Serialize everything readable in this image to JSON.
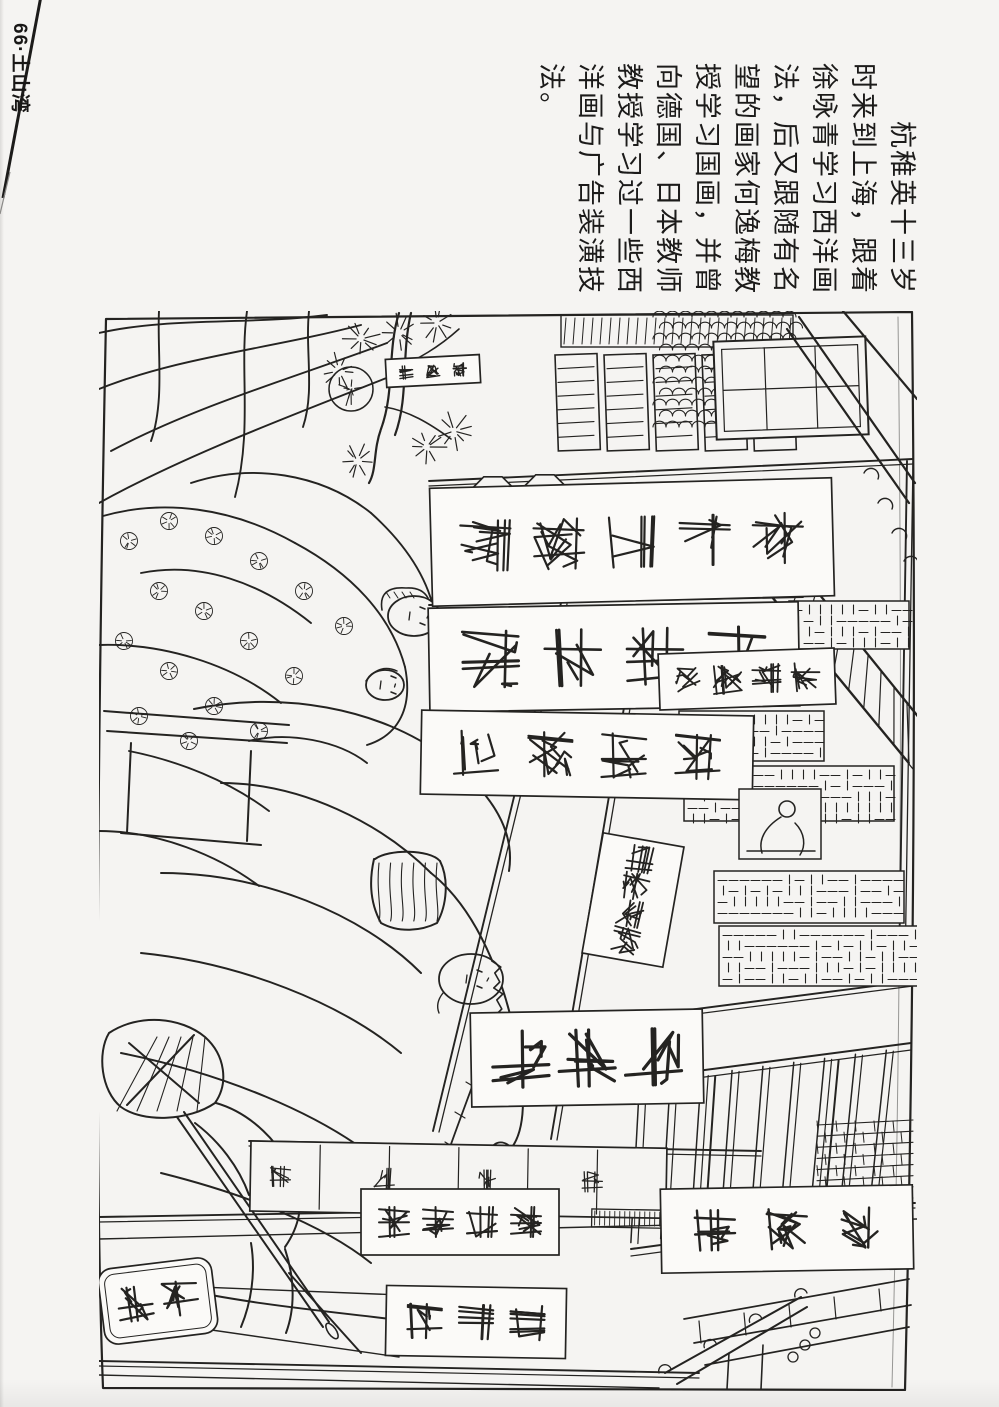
{
  "page": {
    "header": "66·土山湾",
    "caption_lines": [
      "　　杭稚英十三岁",
      "时来到上海，跟着",
      "徐咏青学习西洋画",
      "法，后又跟随有名",
      "望的画家何逸梅教",
      "授学习国画，并曾",
      "向德国、日本教师",
      "教授学习过一些西",
      "洋画与广告装潢技",
      "法。"
    ]
  },
  "colors": {
    "paper": "#f5f4f2",
    "ink": "#242321",
    "banner_fill": "#fbfaf8"
  },
  "illustration": {
    "frame": "M7,8 L813,1 Q819,540 806,1079 L4,1077 Q-8,760 7,8 Z",
    "curl": "M799,6 Q806,540 793,1076",
    "drape_strokes": [
      "M0,22 C70,6 150,14 228,4",
      "M0,78 C80,46 170,38 262,14",
      "M12,140 C95,96 185,70 288,32",
      "M0,192 C90,142 200,102 305,60",
      "M148,0 C140,58 154,118 136,186",
      "M60,0 C58,40 66,90 52,130",
      "M210,0 C206,40 216,80 204,116",
      "M4,205 C64,188 132,196 196,232",
      "M196,232 C252,262 292,304 306,356",
      "M306,356 C314,396 300,424 268,434",
      "M42,262 C102,250 162,272 212,312",
      "M0,334 C62,332 132,352 182,392",
      "M92,172 C152,152 222,162 272,202",
      "M272,202 C312,238 330,272 336,304",
      "M150,430 C190,420 240,430 268,452",
      "M30,440 C80,450 130,470 170,500",
      "M0,520 C60,520 120,545 160,575"
    ],
    "man_strokes": [
      "M95,398 C180,380 280,396 346,446 C396,484 416,522 410,560",
      "M5,400 L190,414",
      "M8,420 L188,432",
      "M32,432 L28,522",
      "M152,440 L148,530",
      "M22,522 L162,534",
      "M122,472 C202,472 282,512 332,562",
      "M62,562 C162,562 262,602 322,662",
      "M42,642 C142,652 242,692 302,742",
      "M22,742 C122,762 222,802 282,852",
      "M62,862 C142,882 222,912 272,952",
      "M72,976 C162,996 252,1002 322,1012",
      "M332,562 C382,602 412,682 422,762 C427,802 422,827 410,840",
      "M276,548 C290,538 330,538 341,550",
      "M275,548 C270,570 271,592 282,612 C300,622 322,620 338,612 C348,594 350,568 341,550"
    ],
    "basket_hatch": {
      "x": 280,
      "y": 552,
      "w": 58,
      "h": 58,
      "n": 6
    },
    "pole_strokes": [
      "M10,722 C40,702 82,706 106,726 C126,744 130,772 116,792 C90,810 44,812 22,796 C2,780 -2,742 10,722",
      "M30,732 L100,792",
      "M95,724 L28,794",
      "M78,806 L224,1016",
      "M85,801 L230,1011",
      "M117,792 C152,802 182,832 196,866 C206,892 200,916 186,936",
      "M152,932 C157,962 152,992 142,1016",
      "M186,938 C196,968 196,998 187,1022",
      "M96,812 C120,830 140,856 150,884",
      "M190,962 L262,1042"
    ],
    "bundle_hatch": {
      "x": 18,
      "y": 726,
      "w": 100,
      "h": 74,
      "n": 5
    },
    "pole_tip": [
      233,
      1020,
      9,
      4
    ],
    "tree": {
      "trunks": [
        "M300,2 C288,40 296,80 282,118 C274,140 278,158 270,172",
        "M312,2 C302,44 310,86 296,124"
      ],
      "branches": [
        "M292,60 C320,48 340,36 360,18",
        "M286,96 C310,100 330,112 352,128"
      ],
      "tufts": [
        [
          262,
          28
        ],
        [
          300,
          22
        ],
        [
          338,
          12
        ],
        [
          355,
          120
        ],
        [
          328,
          136
        ],
        [
          258,
          150
        ],
        [
          240,
          60
        ]
      ]
    },
    "bun": [
      252,
      78,
      22
    ],
    "medallions": [
      [
        30,
        230
      ],
      [
        70,
        210
      ],
      [
        115,
        225
      ],
      [
        160,
        250
      ],
      [
        205,
        280
      ],
      [
        245,
        315
      ],
      [
        60,
        280
      ],
      [
        105,
        300
      ],
      [
        150,
        330
      ],
      [
        195,
        365
      ],
      [
        25,
        330
      ],
      [
        70,
        360
      ],
      [
        115,
        395
      ],
      [
        160,
        420
      ],
      [
        40,
        405
      ],
      [
        90,
        430
      ]
    ],
    "faces": [
      {
        "cx": 315,
        "cy": 305,
        "rx": 26,
        "ry": 20,
        "type": "bonnet"
      },
      {
        "cx": 286,
        "cy": 374,
        "rx": 19,
        "ry": 15,
        "type": "cap"
      },
      {
        "cx": 372,
        "cy": 668,
        "rx": 32,
        "ry": 25,
        "type": "man"
      }
    ],
    "hand": [
      404,
      848,
      13,
      17
    ],
    "braid": "M398,702 C380,762 362,802 342,862",
    "braid_ticks": [
      [
        392,
        714
      ],
      [
        382,
        744
      ],
      [
        372,
        774
      ],
      [
        361,
        804
      ],
      [
        351,
        834
      ]
    ],
    "beams": [
      [
        330,
        170,
        814,
        148
      ],
      [
        330,
        294,
        704,
        286
      ],
      [
        520,
        708,
        814,
        670
      ],
      [
        150,
        830,
        662,
        840
      ],
      [
        0,
        906,
        816,
        892
      ],
      [
        0,
        1050,
        600,
        1062
      ]
    ],
    "posts": [
      [
        462,
        292,
        334,
        820
      ],
      [
        542,
        296,
        452,
        828
      ],
      [
        808,
        150,
        800,
        660
      ]
    ],
    "shutters": {
      "x": 456,
      "y": 44,
      "pw": 42,
      "ph": 96,
      "gap": 7,
      "n": 5,
      "slats": 6
    },
    "upper_band": {
      "x": 462,
      "y": 4,
      "w": 232,
      "h": 32,
      "step": 9
    },
    "scallops": {
      "x": 554,
      "y": 6,
      "w": 142,
      "h": 118,
      "r": 6.5,
      "row": 11
    },
    "gable": {
      "x": 616,
      "y": 28,
      "w": 152,
      "h": 98
    },
    "ridges": [
      "M700,6 L816,172",
      "M688,18 L810,192",
      "M744,0 L818,88"
    ],
    "eave_right": [
      [
        772,
        162
      ],
      [
        786,
        192
      ],
      [
        800,
        222
      ],
      [
        812,
        250
      ]
    ],
    "awning": {
      "a1": [
        614,
        214,
        810,
        452
      ],
      "a2": [
        650,
        196,
        818,
        404
      ],
      "hatch": 13
    },
    "lattices": [
      [
        690,
        290,
        120,
        48
      ],
      [
        580,
        400,
        145,
        50
      ],
      [
        585,
        455,
        210,
        55
      ],
      [
        615,
        560,
        190,
        52
      ],
      [
        620,
        615,
        200,
        60
      ]
    ],
    "stairs": {
      "top": [
        522,
        770,
        812,
        732
      ],
      "bot": [
        532,
        938,
        812,
        900
      ],
      "slats": 9
    },
    "bricks": {
      "x": 718,
      "y": 814,
      "w": 96,
      "h": 78
    },
    "steps": [
      [
        585,
        1008,
        810,
        968
      ],
      [
        595,
        1032,
        812,
        994
      ],
      [
        606,
        1054,
        810,
        1016
      ]
    ],
    "counter": {
      "x": 152,
      "y": 830,
      "w": 416,
      "h": 70,
      "divs": 6,
      "scr": 4
    },
    "base_ticks": {
      "x": 494,
      "y": 892,
      "w": 170,
      "h": 18,
      "step": 5
    },
    "ground": [
      "M0,928 L818,908",
      "M0,972 L352,986",
      "M64,1012 L300,1046",
      "M0,1064 L560,1077"
    ],
    "eave_bottom": {
      "lines": [
        [
          566,
          1062,
          702,
          986
        ],
        [
          578,
          1073,
          708,
          996
        ]
      ],
      "sticks": [
        [
          630,
          1042,
          628,
          1078
        ],
        [
          664,
          1034,
          662,
          1078
        ]
      ],
      "tiles": [
        [
          694,
          1046
        ],
        [
          706,
          1034
        ],
        [
          716,
          1022
        ]
      ]
    },
    "plaques": [
      [
        394,
        188,
        24
      ],
      [
        446,
        186,
        24
      ]
    ],
    "banners": [
      {
        "x": 332,
        "y": 172,
        "w": 402,
        "h": 118,
        "rot": -1.5,
        "n": 5,
        "size": 50,
        "sw": 2.2
      },
      {
        "x": 330,
        "y": 294,
        "w": 370,
        "h": 104,
        "rot": -1,
        "n": 4,
        "size": 56,
        "sw": 2.6
      },
      {
        "x": 322,
        "y": 402,
        "w": 332,
        "h": 84,
        "rot": 1,
        "n": 4,
        "size": 44,
        "sw": 2.2
      },
      {
        "x": 560,
        "y": 340,
        "w": 176,
        "h": 56,
        "rot": -2,
        "n": 4,
        "size": 28,
        "sw": 1.8
      },
      {
        "x": 372,
        "y": 700,
        "w": 232,
        "h": 94,
        "rot": -1,
        "n": 3,
        "size": 56,
        "sw": 3.2
      },
      {
        "x": 262,
        "y": 878,
        "w": 198,
        "h": 66,
        "rot": 0,
        "n": 4,
        "size": 30,
        "sw": 2
      },
      {
        "x": 562,
        "y": 876,
        "w": 252,
        "h": 84,
        "rot": -1,
        "n": 3,
        "size": 40,
        "sw": 2.4
      },
      {
        "x": 2,
        "y": 952,
        "w": 114,
        "h": 76,
        "rot": -7,
        "n": 2,
        "size": 34,
        "sw": 2.2,
        "round": true
      },
      {
        "x": 287,
        "y": 976,
        "w": 180,
        "h": 70,
        "rot": 1,
        "n": 3,
        "size": 34,
        "sw": 2.2
      },
      {
        "x": 493,
        "y": 528,
        "w": 82,
        "h": 122,
        "rot": 10,
        "n": 4,
        "size": 26,
        "sw": 1.8,
        "vert": true
      },
      {
        "x": 287,
        "y": 46,
        "w": 94,
        "h": 28,
        "rot": -3,
        "n": 3,
        "size": 13,
        "sw": 1.4
      }
    ],
    "sitter": {
      "rect": [
        640,
        478,
        82,
        70
      ],
      "head": [
        688,
        498,
        8
      ],
      "strokes": [
        "M682,506 C666,516 659,529 663,542",
        "M696,512 C706,522 707,535 701,544",
        "M648,540 L716,540"
      ]
    }
  }
}
